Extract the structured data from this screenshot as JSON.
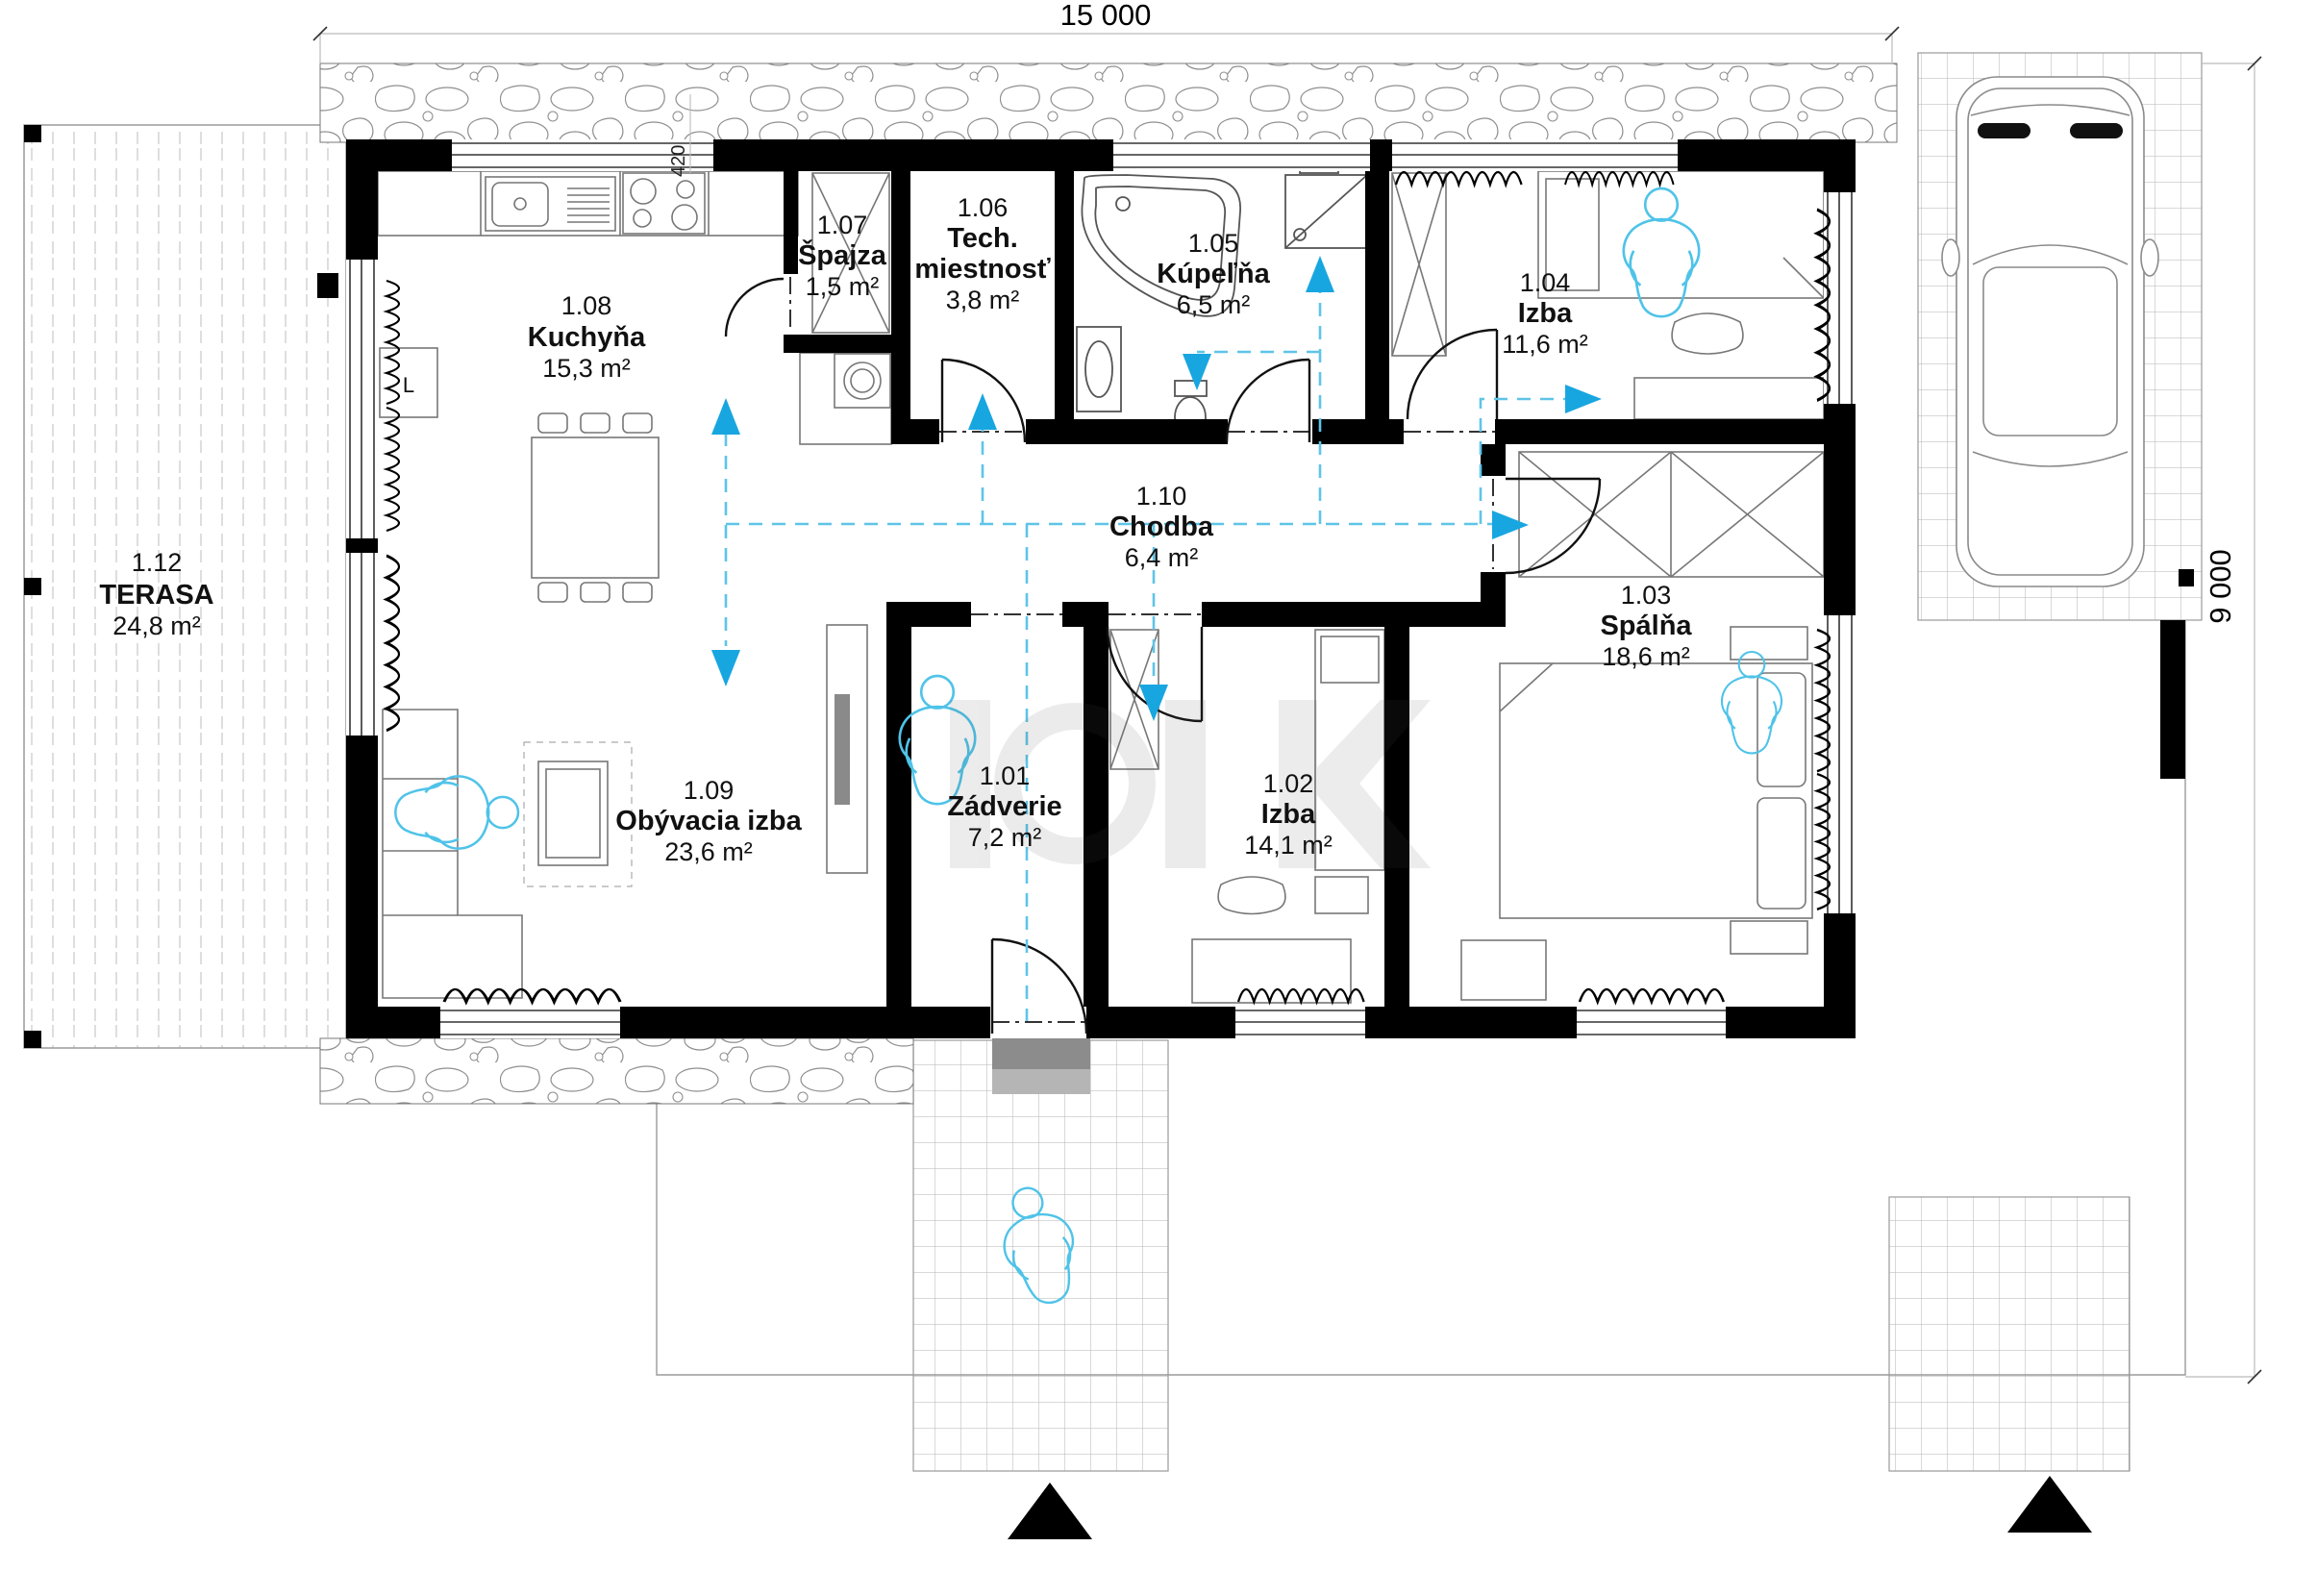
{
  "dimensions": {
    "width": "15 000",
    "height": "9 000",
    "kitchen_counter": "420"
  },
  "rooms": {
    "zadverie": {
      "id": "1.01",
      "name": "Zádverie",
      "area": "7,2 m²"
    },
    "izba2": {
      "id": "1.02",
      "name": "Izba",
      "area": "14,1 m²"
    },
    "spalna": {
      "id": "1.03",
      "name": "Spálňa",
      "area": "18,6 m²"
    },
    "izba4": {
      "id": "1.04",
      "name": "Izba",
      "area": "11,6 m²"
    },
    "kupelna": {
      "id": "1.05",
      "name": "Kúpeľňa",
      "area": "6,5 m²"
    },
    "tech": {
      "id": "1.06",
      "name": "Tech.",
      "name2": "miestnosť",
      "area": "3,8 m²"
    },
    "spajza": {
      "id": "1.07",
      "name": "Špajza",
      "area": "1,5 m²"
    },
    "kuchyna": {
      "id": "1.08",
      "name": "Kuchyňa",
      "area": "15,3 m²"
    },
    "obyvacia": {
      "id": "1.09",
      "name": "Obývacia izba",
      "area": "23,6 m²"
    },
    "chodba": {
      "id": "1.10",
      "name": "Chodba",
      "area": "6,4 m²"
    },
    "terasa": {
      "id": "1.12",
      "name": "TERASA",
      "area": "24,8 m²"
    }
  },
  "furniture": {
    "fridge_label": "L"
  },
  "icons": {
    "vent_arrow": "filled-triangle-cyan",
    "entrance_marker": "filled-triangle-black",
    "person_figure": "cyan-outline-person"
  },
  "colors": {
    "wall": "#000000",
    "vent_line": "#5fc4e8",
    "vent_arrow": "#18a6e0",
    "figure": "#4fc3e8",
    "stone_outline": "#8f8f8f",
    "paving_grid": "#b3b3b3"
  }
}
